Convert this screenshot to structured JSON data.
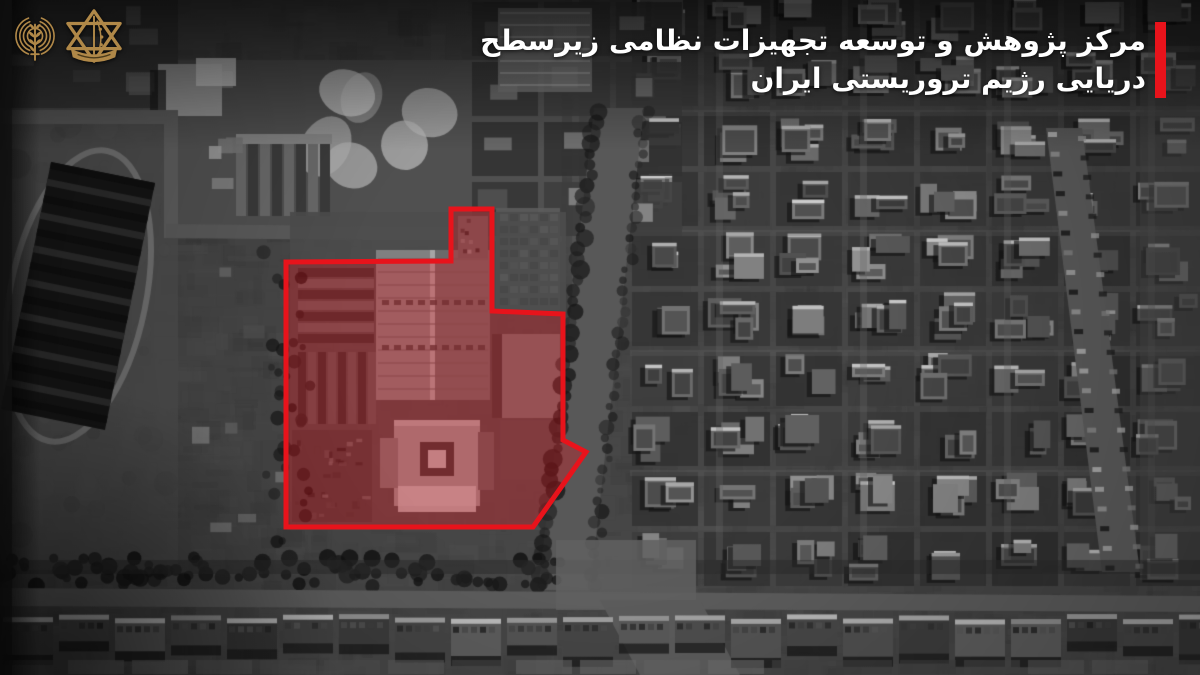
{
  "view": {
    "width": 1200,
    "height": 675,
    "kind": "black-and-white satellite aerial image with red target annotation"
  },
  "branding": {
    "gold_color": "#b08848",
    "logos": [
      {
        "name": "radio-waves-olive-branch-emblem"
      },
      {
        "name": "idf-star-of-david-emblem"
      }
    ]
  },
  "headline": {
    "line1": "مرکز پژوهش و توسعه تجهیزات نظامی زیرسطح",
    "line2": "دریایی رژیم تروریستی ایران",
    "direction": "rtl",
    "text_color": "#ffffff",
    "accent_bar_color": "#e8131b"
  },
  "annotation": {
    "name": "highlighted-target-compound",
    "stroke_color": "#e8131b",
    "stroke_width": 5,
    "fill_color": "rgba(232,19,27,0.33)",
    "polygon_points": "286,262 451,261 451,209 492,209 492,311 563,314 563,440 586,452 533,527 286,527"
  }
}
